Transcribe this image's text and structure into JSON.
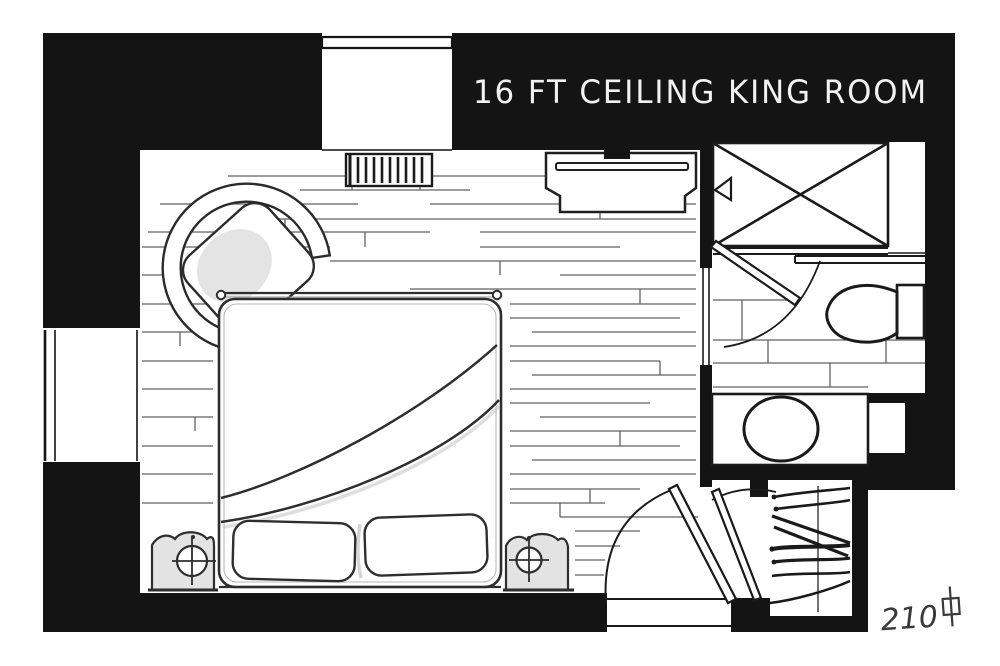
{
  "image": {
    "title": "16 FT CEILING KING ROOM",
    "room_number": "210",
    "room_number_symbol": "#"
  },
  "colors": {
    "ink": "#141414",
    "paper": "#ffffff",
    "pencil": "#4f4f4f",
    "title_text": "#f2f2f2",
    "room_number_color": "#3a3a3a"
  },
  "furniture_icons": [
    "armchair",
    "radiator",
    "dresser-tv-console",
    "king-bed",
    "pillow",
    "nightstand-lamp",
    "window",
    "shower",
    "shower-head",
    "bathroom-door",
    "toilet",
    "vanity-sink",
    "entry-door",
    "closet-door",
    "closet-hangers"
  ]
}
